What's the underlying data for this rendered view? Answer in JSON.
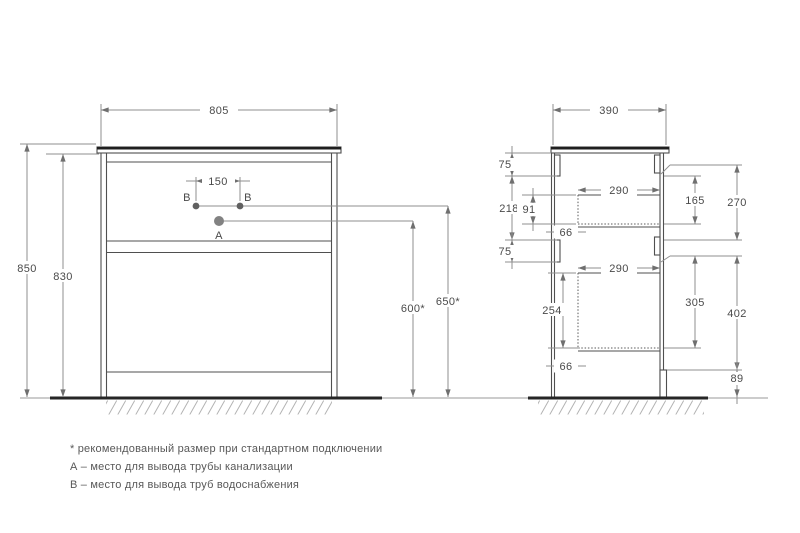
{
  "front_view": {
    "dim_width": "805",
    "dim_height_total": "850",
    "dim_height_cabinet": "830",
    "dim_hole_spacing": "150",
    "dim_drain_height": "600*",
    "dim_supply_height": "650*",
    "label_a": "A",
    "label_b_left": "B",
    "label_b_right": "B"
  },
  "side_view": {
    "dim_depth": "390",
    "dim_top_rail": "75",
    "dim_opening_height": "218",
    "dim_drawer_side_upper": "91",
    "dim_mid_rail": "75",
    "dim_drawer_width_upper": "290",
    "dim_front_offset_upper": "66",
    "dim_drawer_box_upper": "165",
    "dim_upper_section": "270",
    "dim_drawer_width_lower": "290",
    "dim_drawer_side_lower": "254",
    "dim_front_offset_lower": "66",
    "dim_drawer_box_lower": "305",
    "dim_lower_section": "402",
    "dim_plinth_height": "89"
  },
  "notes": {
    "line1": "* рекомендованный размер при стандартном подключении",
    "line2": "А – место для вывода трубы канализации",
    "line3": "B – место для вывода труб водоснабжения"
  },
  "colors": {
    "outline": "#4f4f4f",
    "dimension_lines": "#8f8f8f",
    "strong_lines": "#262626",
    "text": "#4a4a4a",
    "point_a_dot": "#808080",
    "point_b_dot": "#606060"
  }
}
